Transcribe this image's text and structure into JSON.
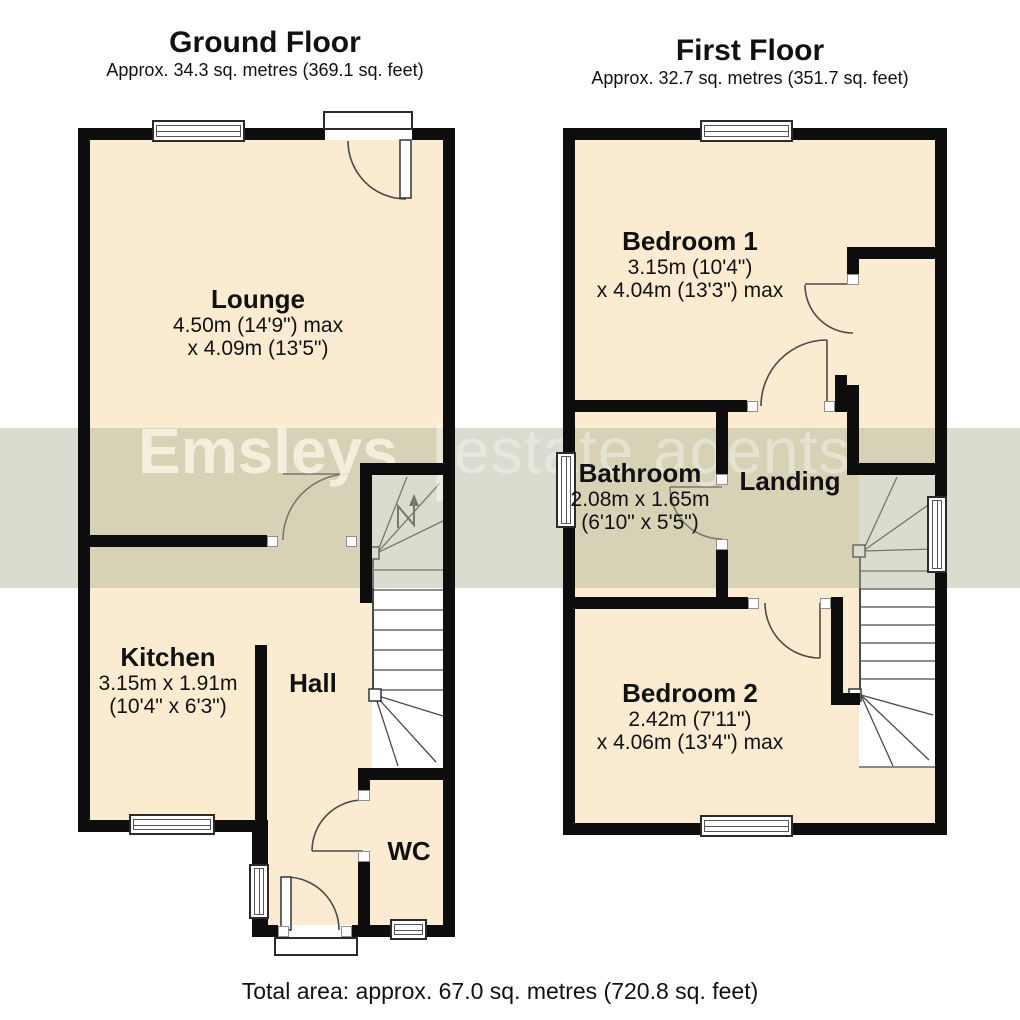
{
  "ground_floor": {
    "title": "Ground Floor",
    "subtitle": "Approx. 34.3 sq. metres (369.1 sq. feet)",
    "rooms": {
      "lounge": {
        "name": "Lounge",
        "dim_metric": "4.50m (14'9\") max",
        "dim_imperial": "x 4.09m (13'5\")"
      },
      "kitchen": {
        "name": "Kitchen",
        "dim_metric": "3.15m x 1.91m",
        "dim_imperial": "(10'4\" x 6'3\")"
      },
      "hall": {
        "name": "Hall"
      },
      "wc": {
        "name": "WC"
      }
    }
  },
  "first_floor": {
    "title": "First Floor",
    "subtitle": "Approx. 32.7 sq. metres (351.7 sq. feet)",
    "rooms": {
      "bedroom1": {
        "name": "Bedroom 1",
        "dim_metric": "3.15m (10'4\")",
        "dim_imperial": "x 4.04m (13'3\") max"
      },
      "bathroom": {
        "name": "Bathroom",
        "dim_metric": "2.08m x 1.65m",
        "dim_imperial": "(6'10\" x 5'5\")"
      },
      "landing": {
        "name": "Landing"
      },
      "bedroom2": {
        "name": "Bedroom 2",
        "dim_metric": "2.42m (7'11\")",
        "dim_imperial": "x 4.06m (13'4\") max"
      }
    }
  },
  "watermark": {
    "brand": "Emsleys",
    "divider": "|",
    "suffix": "estate agents"
  },
  "footer": {
    "total_area": "Total area: approx. 67.0 sq. metres (720.8 sq. feet)"
  },
  "colors": {
    "room_fill": "#fbecd1",
    "wall": "#0d0d0d",
    "stair_fill": "#ffffff",
    "watermark_band": "rgba(170,178,148,0.45)",
    "line": "#4a4a4a"
  }
}
